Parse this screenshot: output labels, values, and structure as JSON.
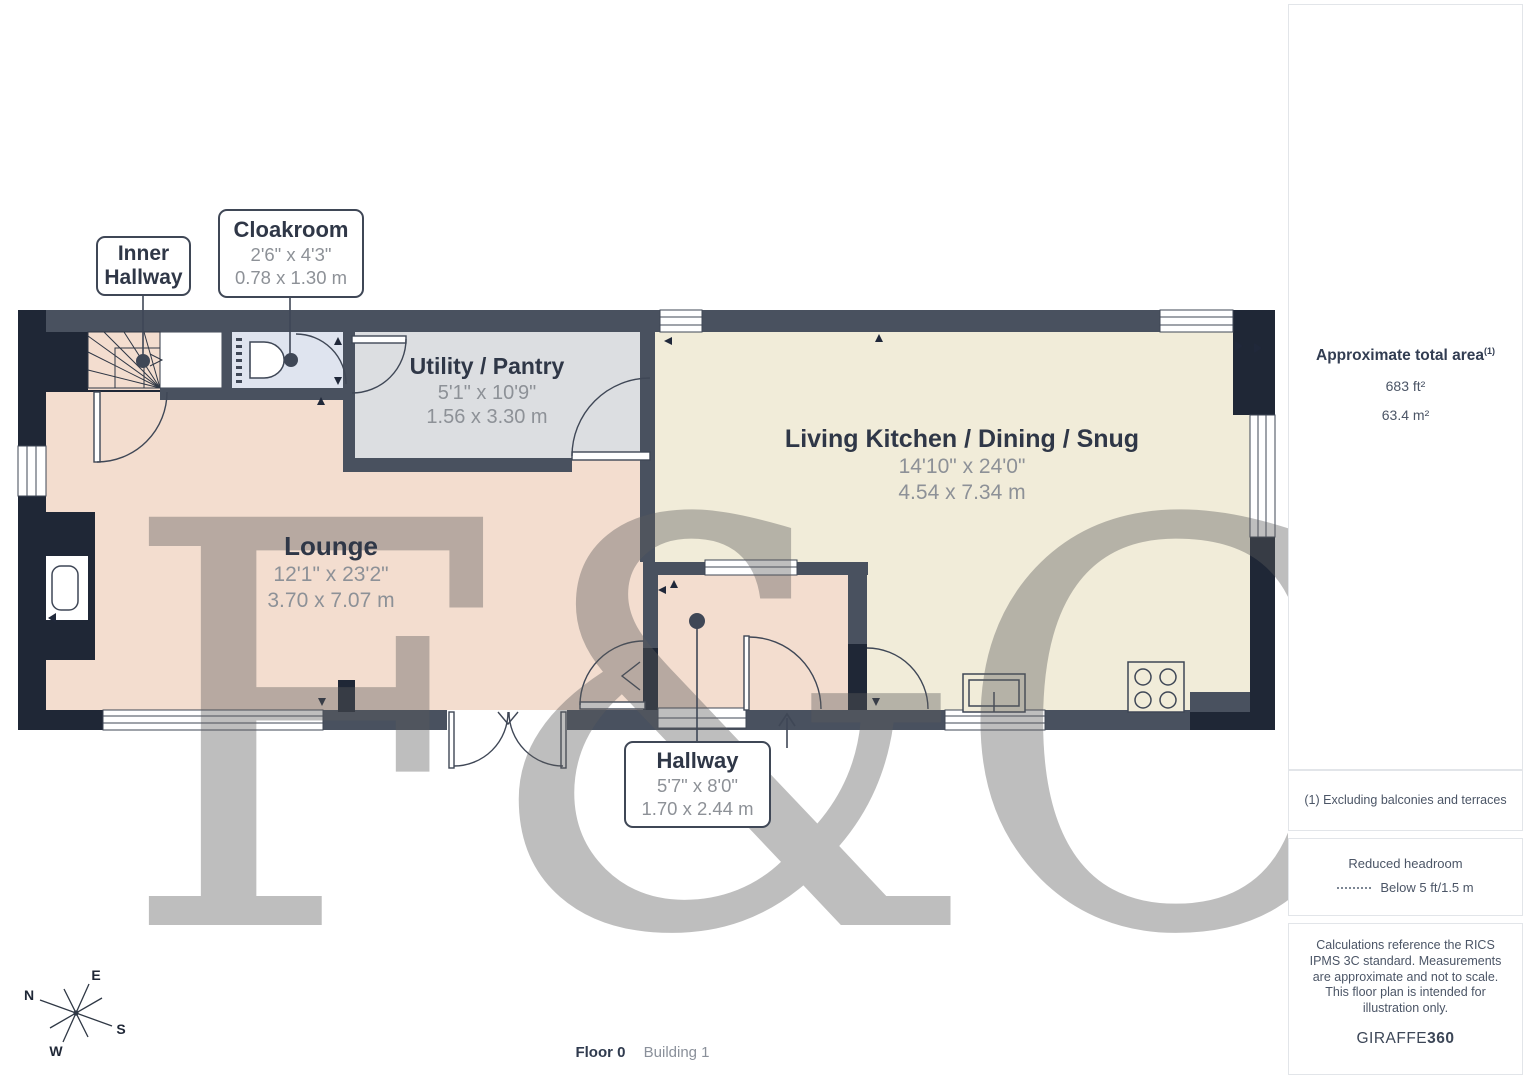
{
  "plan": {
    "watermark": "F&C",
    "labels": {
      "inner_hallway": {
        "name": "Inner Hallway"
      },
      "cloakroom": {
        "name": "Cloakroom",
        "imperial": "2'6\" x 4'3\"",
        "metric": "0.78 x 1.30 m"
      },
      "utility": {
        "name": "Utility / Pantry",
        "imperial": "5'1\" x 10'9\"",
        "metric": "1.56 x 3.30 m"
      },
      "living_kitchen": {
        "name": "Living Kitchen / Dining / Snug",
        "imperial": "14'10\" x 24'0\"",
        "metric": "4.54 x 7.34 m"
      },
      "lounge": {
        "name": "Lounge",
        "imperial": "12'1\" x 23'2\"",
        "metric": "3.70 x 7.07 m"
      },
      "hallway": {
        "name": "Hallway",
        "imperial": "5'7\" x 8'0\"",
        "metric": "1.70 x 2.44 m"
      }
    },
    "compass": {
      "n": "N",
      "e": "E",
      "s": "S",
      "w": "W"
    }
  },
  "sidebar": {
    "area_title": "Approximate total area",
    "area_sup": "(1)",
    "area_ft": "683 ft²",
    "area_m": "63.4 m²",
    "footnote": "(1) Excluding balconies and terraces",
    "headroom_title": "Reduced headroom",
    "headroom_value": "Below 5 ft/1.5 m",
    "disclaimer": "Calculations reference the RICS IPMS 3C standard. Measurements are approximate and not to scale. This floor plan is intended for illustration only.",
    "brand": "GIRAFFE",
    "brand_bold": "360"
  },
  "footer": {
    "floor": "Floor 0",
    "building": "Building 1"
  },
  "colors": {
    "wall_dark": "#1f2736",
    "wall_slate": "#49515f",
    "floor_peach": "#f3ddcf",
    "floor_cream": "#f1ecd9",
    "floor_gray": "#dcdee1",
    "floor_blue": "#dfe4ef"
  }
}
